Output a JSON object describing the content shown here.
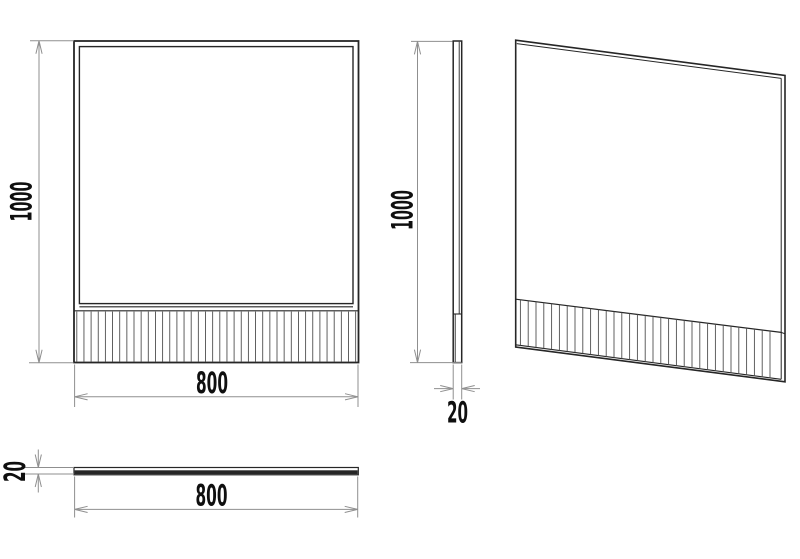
{
  "drawing": {
    "type": "technical-drawing",
    "views": {
      "front": {
        "height": "1000",
        "width": "800"
      },
      "side": {
        "height": "1000",
        "thickness": "20"
      },
      "top": {
        "length": "800",
        "thickness": "20"
      }
    },
    "colors": {
      "background": "#ffffff",
      "outline": "#262626",
      "rib": "#4f4f4f",
      "dimension": "#8f8f8f",
      "text": "#0f0f0f"
    }
  }
}
